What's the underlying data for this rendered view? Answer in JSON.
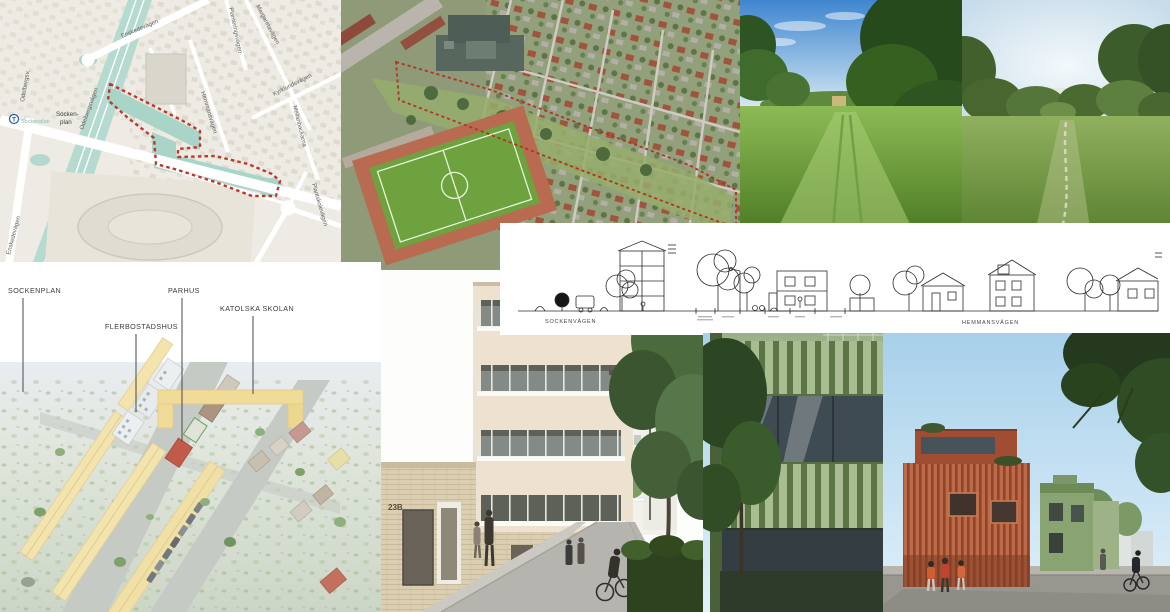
{
  "map": {
    "station_symbol": "T",
    "labels": {
      "enskedevagen": "Enskedevägen",
      "enskedevagen_south": "Enskedevägen",
      "odelbergsvagen": "Odelbergsvägen",
      "odelbergsv_short": "Odelbergsv.",
      "sockenplan_1": "Socken-",
      "sockenplan_2": "plan",
      "sockenplan_station": "Sockenplan",
      "hemmansvagen": "Hemmansvägen",
      "margaretavagen": "Margaretavägen",
      "planteringsvagen": "Planteringsvägen",
      "kyrklundsvagen": "Kyrklundsvägen",
      "mellanbackarna": "Mellanbackarna",
      "plantskolevagen": "Plantskolevägen"
    },
    "colors": {
      "background": "#edebe3",
      "water_green": "#a9d5c9",
      "boundary_red": "#b93a2b"
    }
  },
  "aerial": {
    "colors": {
      "boundary_red": "#b03522",
      "football_field": "#6da23e",
      "school_roof": "#57675e"
    }
  },
  "section": {
    "labels": {
      "left": "SOCKENVÄGEN",
      "right": "HEMMANSVÄGEN"
    }
  },
  "illustration": {
    "labels": {
      "sockenplan": "SOCKENPLAN",
      "flerbostadshus": "FLERBOSTADSHUS",
      "parhus": "PARHUS",
      "katolska_skolan": "KATOLSKA SKOLAN"
    },
    "colors": {
      "building_cream": "#f3e3ad",
      "parhus_red": "#c05a49",
      "school_yellow": "#f0db99"
    }
  },
  "street_white": {
    "address_sign": "23B"
  },
  "street_green": {
    "colors": {
      "facade_green": "#9cb089",
      "facade_red": "#b25b3d"
    }
  }
}
